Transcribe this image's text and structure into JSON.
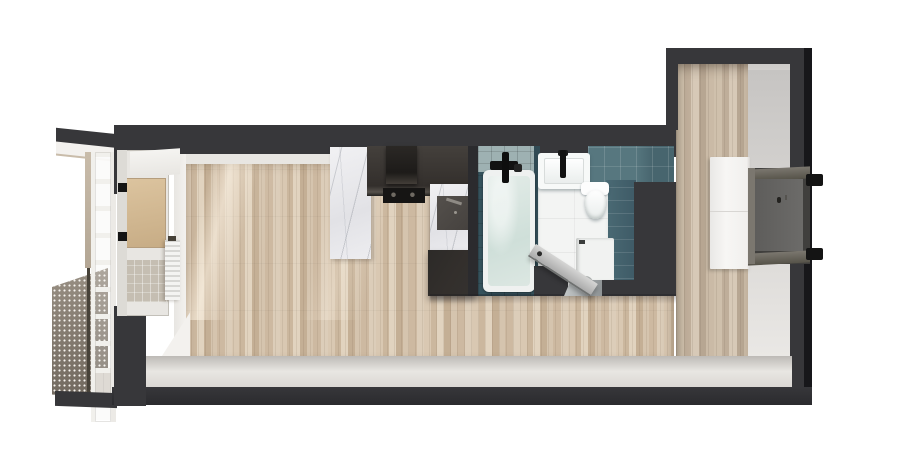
{
  "scene": {
    "type": "apartment-floor-plan-3d-render",
    "visible_text": "",
    "rooms": [
      {
        "name": "balcony",
        "fixtures": [
          "perforated-mesh-railing",
          "glazing-ladder",
          "corner-post",
          "balcony-floor",
          "roof-slab"
        ]
      },
      {
        "name": "living-room-kitchen",
        "fixtures": [
          "wood-plank-floor",
          "balcony-door",
          "radiator",
          "marble-counter-left",
          "upper-cabinets",
          "range-hood",
          "cooktop",
          "oven",
          "marble-counter-right",
          "base-cabinet",
          "sunlight-patches"
        ]
      },
      {
        "name": "bathroom",
        "fixtures": [
          "bathtub",
          "tub-faucet",
          "sink",
          "sink-faucet",
          "wall-hung-toilet",
          "washing-machine",
          "teal-tile-walls",
          "white-tile-floor",
          "threshold",
          "open-door"
        ]
      },
      {
        "name": "hallway",
        "fixtures": [
          "wood-plank-floor",
          "wardrobe",
          "entry-door",
          "door-hinges"
        ]
      }
    ]
  },
  "palette": {
    "wall": "#37373a",
    "wall-dark": "#2b2b2e",
    "wall-edge": "#17171a",
    "face-white": "#f3f1ee",
    "band-a": "#bdbab6",
    "band-b": "#e8e6e2",
    "band-c": "#d8d5d1",
    "ceiling": "#c9c7c5",
    "right-face-a": "#c6c4c2",
    "right-face-b": "#eeece9",
    "wood-a": "#d9c8b2",
    "wood-b": "#cbb79e",
    "wood-c": "#e1d3bf",
    "wood-d": "#c4af95",
    "hall-a": "#cfc0ac",
    "hall-b": "#bfae9a",
    "hall-c": "#d7c9b7",
    "hall-d": "#b7a692",
    "marble-a": "#f1f1f3",
    "marble-b": "#e2e2e6",
    "cabinet-a": "#44403c",
    "cabinet-b": "#332f2c",
    "cabinet-edge": "#57524c",
    "hood": "#1d1b19",
    "cooktop": "#161514",
    "oven-a": "#54504c",
    "oven-b": "#45413e",
    "handle-metal": "#8e8a84",
    "tile-band-a": "#57777f",
    "tile-band-b": "#47656e",
    "tile-face-a": "#4a6a74",
    "tile-face-b": "#3e5a66",
    "tile-strip-a": "#35525c",
    "tile-deck": "#9eb1b2",
    "divider": "#314b55",
    "tub-rim": "#eff1f0",
    "tub-a": "#e3ece8",
    "tub-b": "#cfdfd9",
    "faucet": "#121212",
    "fixture-white": "#f7f9f8",
    "fixture-shade": "#e9edec",
    "bath-floor": "#f3f4f3",
    "washer-top": "#f1f2f1",
    "washer-front": "#dfe1e0",
    "washer-ring": "#aeb2b1",
    "th-a": "#c2c6c7",
    "th-b": "#8f9496",
    "door-a": "#d6d6d5",
    "door-b": "#ababab",
    "door-edge": "#6f7170",
    "handle-dark": "#2b2b2b",
    "niche": "#403f3d",
    "frame-a": "#7b776f",
    "frame-b": "#565349",
    "leaf-a": "#5e5d5b",
    "leaf-b": "#6c6b69",
    "keyhole": "#23221f",
    "hinge": "#141414",
    "wardrobe-a": "#e9e8e6",
    "wardrobe-b": "#f7f6f4",
    "seam": "#d8d6d3",
    "mesh-a": "#9a9185",
    "mesh-b": "#6e665c",
    "mesh-dot": "#f6f3ee",
    "post": "#c9bcaa",
    "post-dark": "#474239",
    "bal-floor": "#d5cfc8",
    "ladder": "#f1f0ec",
    "ladder-shade": "#eceae6",
    "pane-a": "#dcc49f",
    "pane-b": "#c7ac85",
    "pane-lower": "#c5beb2",
    "frame-white": "#e8e6e2",
    "rad": "#f4f4f2",
    "rad-fin": "#d7d7d4",
    "sun": "#fff6e8"
  }
}
